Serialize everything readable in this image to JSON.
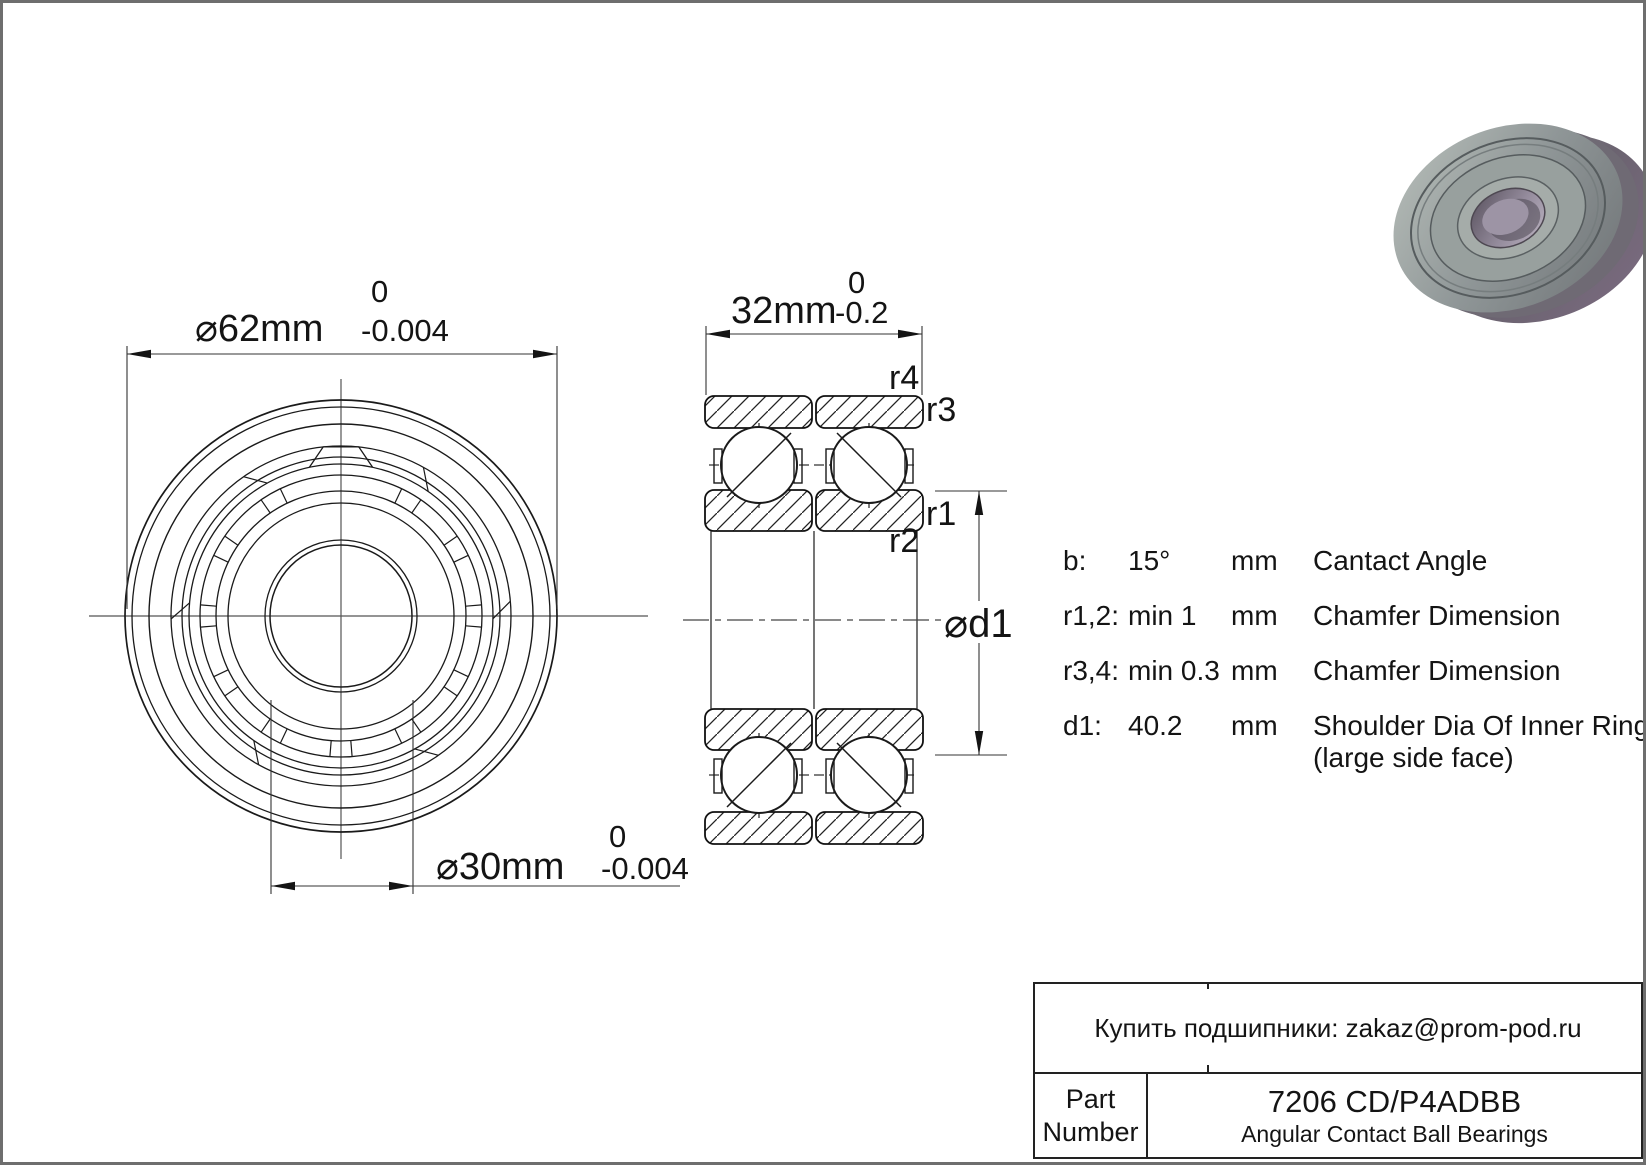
{
  "colors": {
    "line": "#1a1a1a",
    "centerline": "#555555",
    "page_border": "#6e6e6e",
    "metal_gray": "#8b9294",
    "metal_purple": "#7b6b80"
  },
  "dimensions": {
    "outer_diameter": {
      "text": "⌀62mm",
      "tol_upper": "0",
      "tol_lower": "-0.004"
    },
    "bore_diameter": {
      "text": "⌀30mm",
      "tol_upper": "0",
      "tol_lower": "-0.004"
    },
    "width": {
      "text": "32mm",
      "tol_upper": "0",
      "tol_lower": "-0.2"
    },
    "shoulder_diameter_label": "⌀d1"
  },
  "section_labels": {
    "r1": "r1",
    "r2": "r2",
    "r3": "r3",
    "r4": "r4"
  },
  "specs": {
    "rows": [
      {
        "label": "b:",
        "value": "15°",
        "unit": "mm",
        "desc": "Cantact Angle",
        "desc2": ""
      },
      {
        "label": "r1,2:",
        "value": "min  1",
        "unit": "mm",
        "desc": "Chamfer Dimension",
        "desc2": ""
      },
      {
        "label": "r3,4:",
        "value": "min  0.3",
        "unit": "mm",
        "desc": "Chamfer Dimension",
        "desc2": ""
      },
      {
        "label": "d1:",
        "value": "40.2",
        "unit": "mm",
        "desc": "Shoulder Dia Of Inner Ring",
        "desc2": "(large side face)"
      }
    ]
  },
  "title_block": {
    "supplier_line": "Купить подшипники: zakaz@prom-pod.ru",
    "part_label_line1": "Part",
    "part_label_line2": "Number",
    "part_number": "7206 CD/P4ADBB",
    "bearing_type": "Angular Contact Ball Bearings"
  }
}
